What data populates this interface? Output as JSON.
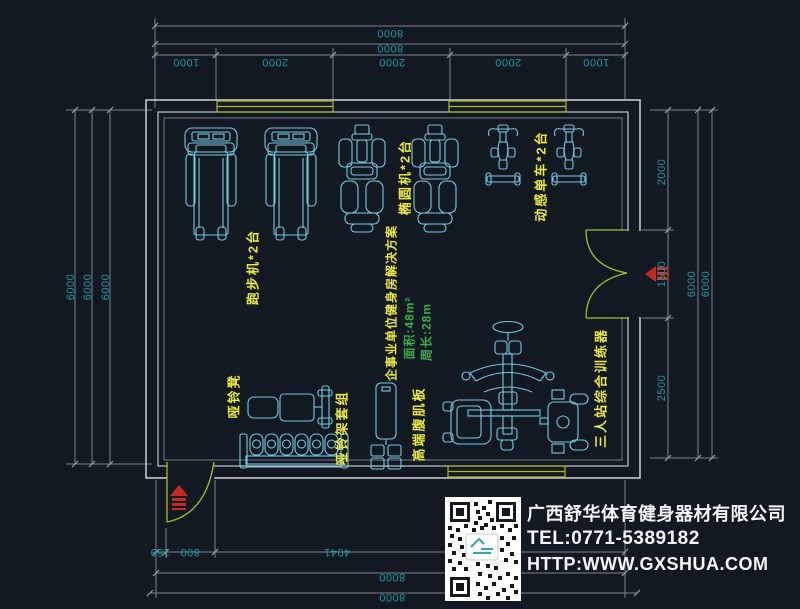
{
  "colors": {
    "background": "#131922",
    "walls": "#c3c8cd",
    "dimension_lines": "#7b838c",
    "dimension_text": "#1f96a4",
    "equipment_lines": "#77c9e3",
    "label_yellow": "#e9e83c",
    "stats_green": "#3bae4b",
    "openings_green": "#a2bf2a",
    "marker_red": "#c42b20",
    "company_text": "#f4f6f8"
  },
  "dimensions": {
    "top": {
      "overall_outer": "8000",
      "overall_inner": "8000",
      "segments": [
        "1000",
        "2000",
        "2000",
        "2000",
        "1000"
      ]
    },
    "left": {
      "overall": [
        "6000",
        "6000",
        "6000"
      ]
    },
    "right": {
      "segments": [
        "2000",
        "1500",
        "2500"
      ],
      "overall": [
        "6000",
        "6000"
      ]
    },
    "bottom": {
      "segments": [
        "159",
        "800",
        "4041"
      ],
      "overall_inner": "8000",
      "overall_outer": "8000"
    }
  },
  "equipment_labels": {
    "treadmill": "跑步机*2台",
    "elliptical": "椭圆机*2台",
    "spin_bike": "动感单车*2台",
    "dumbbell_bench": "哑铃凳",
    "dumbbell_rack": "哑铃架套组",
    "ab_board": "高端腹肌板",
    "multi_station_trainer": "三人站综合训练器"
  },
  "plan_info": {
    "title": "企事业单位健身房解决方案",
    "area": "面积:48m²",
    "perimeter": "周长:28m"
  },
  "company": {
    "name": "广西舒华体育健身器材有限公司",
    "tel": "TEL:0771-5389182",
    "website": "HTTP:WWW.GXSHUA.COM"
  }
}
